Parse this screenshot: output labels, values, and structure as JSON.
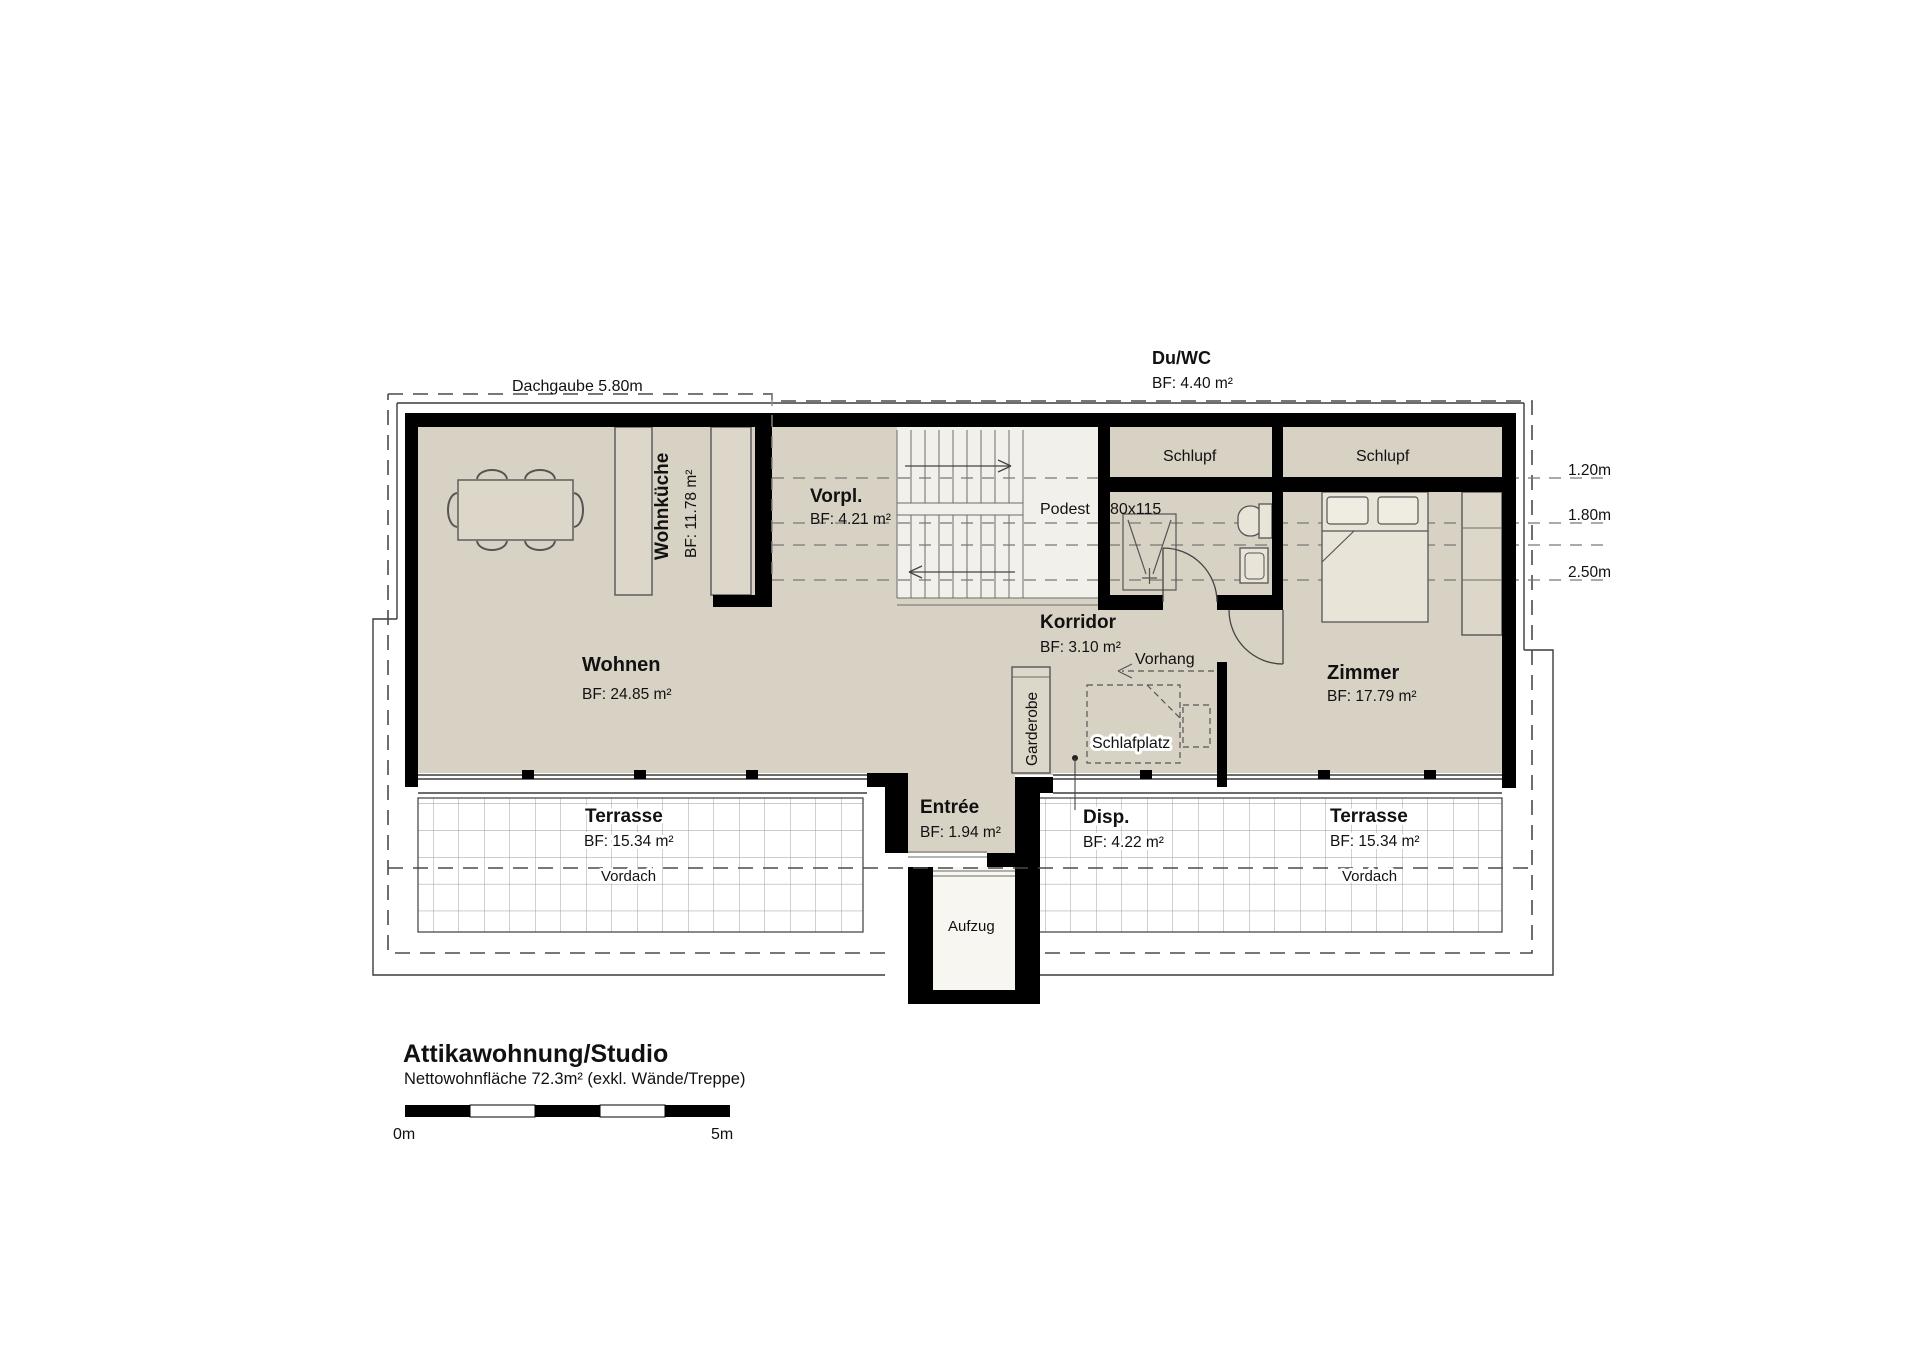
{
  "plan": {
    "dormer_label": "Dachgaube 5.80m",
    "duwc": {
      "name": "Du/WC",
      "area": "BF: 4.40 m²"
    },
    "rooms": {
      "wohnkueche": {
        "name": "Wohnküche",
        "area": "BF:  11.78 m²"
      },
      "vorplatz": {
        "name": "Vorpl.",
        "area": "BF: 4.21 m²"
      },
      "wohnen": {
        "name": "Wohnen",
        "area": "BF: 24.85 m²"
      },
      "korridor": {
        "name": "Korridor",
        "area": "BF: 3.10 m²"
      },
      "zimmer": {
        "name": "Zimmer",
        "area": "BF: 17.79 m²"
      },
      "entree": {
        "name": "Entrée",
        "area": "BF: 1.94 m²"
      },
      "disp": {
        "name": "Disp.",
        "area": "BF: 4.22 m²"
      },
      "terrasse_links": {
        "name": "Terrasse",
        "area": "BF: 15.34 m²"
      },
      "terrasse_rechts": {
        "name": "Terrasse",
        "area": "BF: 15.34 m²"
      }
    },
    "annotations": {
      "schlupf_links": "Schlupf",
      "schlupf_rechts": "Schlupf",
      "podest": "Podest",
      "shower_size": "80x115",
      "vorhang": "Vorhang",
      "schlafplatz": "Schlafplatz",
      "garderobe": "Garderobe",
      "aufzug": "Aufzug",
      "vordach_links": "Vordach",
      "vordach_rechts": "Vordach"
    },
    "roof_heights": [
      "1.20m",
      "1.80m",
      "2.50m"
    ]
  },
  "title_block": {
    "title": "Attikawohnung/Studio",
    "subtitle": "Nettowohnfläche 72.3m² (exkl. Wände/Treppe)",
    "scale_start": "0m",
    "scale_end": "5m"
  },
  "colors": {
    "wall": "#000000",
    "floor": "#d8d2c4",
    "stair": "#f2f0ea",
    "furniture": "#ddd7c9",
    "grid_line": "#9a9a9a"
  }
}
